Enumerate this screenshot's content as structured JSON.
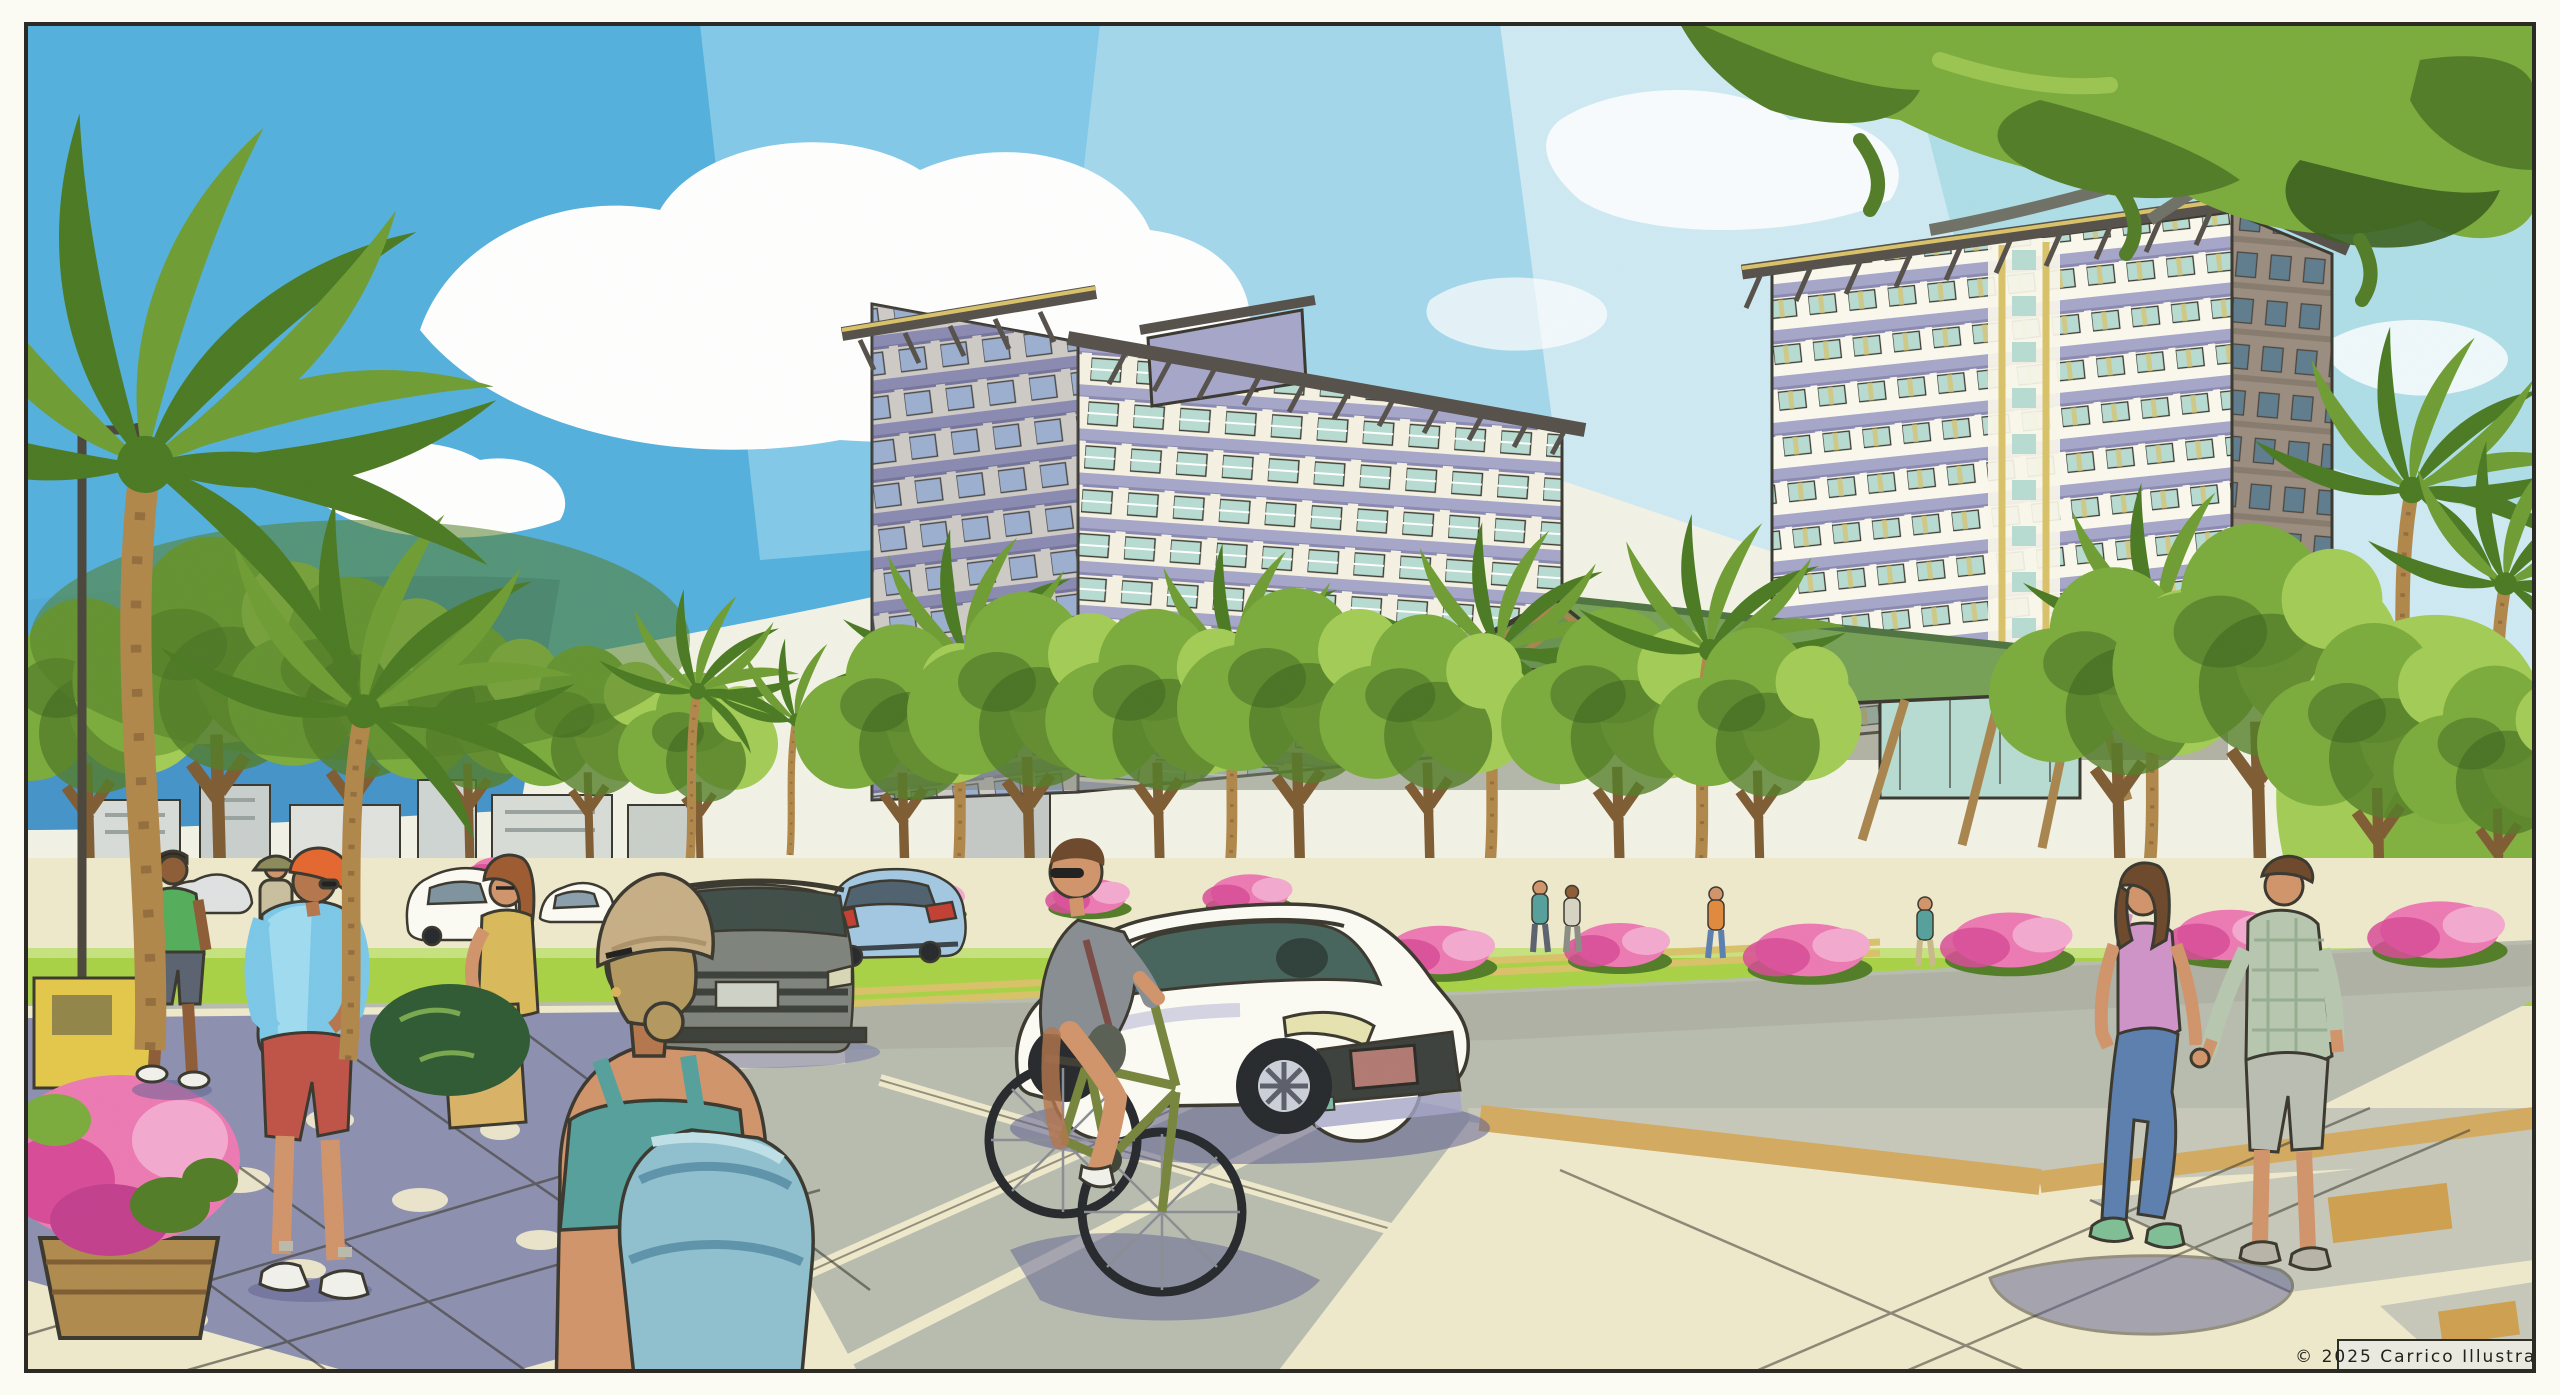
{
  "artwork": {
    "medium": "watercolor and ink architectural rendering",
    "caption": "© 2025  Carrico Illustration"
  },
  "scene": {
    "setting": "sunny tropical resort boulevard with landscaped medians, street trees and a foreground crosswalk",
    "sky": "blue watercolor sky with large white cumulus clouds, paler toward the right",
    "buildings": [
      {
        "name": "left-midrise",
        "floors_visible": 10,
        "features": "deep bracketed roof overhangs, lavender balcony bands, teal glazing, rooftop stair box, green entry canopy"
      },
      {
        "name": "right-tower",
        "floors_visible": 13,
        "features": "white frame facade with recessed lavender balconies, yellow core accents, bracketed eave, shaded taupe side wall"
      },
      {
        "name": "amenity-pavilion",
        "features": "low glass pavilion, green sloped metal roof, exposed timber trusses and angled struts"
      }
    ],
    "vehicles": [
      {
        "name": "white-sedan",
        "pose": "three-quarter front view driving toward viewer, dark grille, rose license plate"
      },
      {
        "name": "gray-suv",
        "pose": "front view in far lane"
      },
      {
        "name": "light-blue-sedan",
        "pose": "rear view driving away, red taillights"
      },
      {
        "name": "parked-white-cars",
        "pose": "along far left curb"
      }
    ],
    "people": [
      {
        "name": "cyclist",
        "desc": "man with sunglasses on olive-green bicycle, gray shirt, crossbody bag, white sneakers"
      },
      {
        "name": "man-orange-cap",
        "desc": "standing with hands on hips, light blue tee, red shorts, white sneakers"
      },
      {
        "name": "man-green-polo",
        "desc": "walking, green polo, gray shorts, white sneakers"
      },
      {
        "name": "woman-yellow-top",
        "desc": "auburn hair, glasses, mustard top, tan tote bag"
      },
      {
        "name": "woman-foreground",
        "desc": "back view, tan beanie over blonde bun, sunglasses, teal tank, large teal backpack"
      },
      {
        "name": "pedestrian-bucket-hat",
        "desc": "distant walker in olive bucket hat"
      },
      {
        "name": "couple-walking",
        "desc": "woman in pink cami, jeans and green sneakers holding hands with man in sage plaid shirt and gray shorts"
      },
      {
        "name": "distant-pedestrians",
        "desc": "small figures strolling the far promenade"
      }
    ],
    "vegetation": [
      "tall coconut palms on the left",
      "bright street-tree allee in front of the buildings",
      "pink azalea masses along the medians",
      "overhanging shade-tree canopy across the top right",
      "barrel planter of magenta petunias at lower left"
    ],
    "street": [
      "double yellow center line",
      "cream crosswalk and lane markings",
      "lime lawn median strips",
      "tan paver accent bands",
      "dappled leaf shadows on the sidewalk",
      "street light pole"
    ]
  },
  "palette": {
    "ink": "#3a382e",
    "frame": "#2b2a24",
    "paper": "#fbfaf3",
    "artBase": "#f2f3e6",
    "skyDeep": "#54b0dd",
    "skyMid": "#8fd0ec",
    "skyPale": "#cfeaf4",
    "skyAqua": "#9fd9e2",
    "horizon": "#4493c9",
    "cloud": "#ffffff",
    "cloudShade": "#dceef4",
    "leafLight": "#a3cc55",
    "leafMid": "#7bab3c",
    "leafDark": "#527d27",
    "leafDeep": "#3a5f1d",
    "lawn": "#a9d246",
    "lawnPale": "#c6e27e",
    "palmLight": "#6f9d33",
    "palmDark": "#4b7a22",
    "trunk": "#b1874a",
    "trunkDark": "#7e5c33",
    "branch": "#6f7166",
    "facade": "#f5f2e3",
    "facadeShade": "#ddd9cc",
    "lavender": "#a6a6c9",
    "lavenderDeep": "#8a8ab2",
    "glass": "#b7dcd2",
    "glassBlue": "#9fb7d6",
    "glassDark": "#5e7d8e",
    "taupe": "#9a8d7f",
    "accentYellow": "#d9c268",
    "roofDark": "#55504a",
    "roofGreen": "#76a156",
    "timber": "#a9854d",
    "road": "#b8bcae",
    "roadShade": "#a6aa9c",
    "cream": "#efe9cc",
    "tanBand": "#d3aa60",
    "ochre": "#cfa04f",
    "paverGray": "#c6c8ba",
    "shadow": "#7478a8",
    "shadowDeep": "#5c5f92",
    "skin": "#d1946a",
    "skinShade": "#b5764c",
    "skinDark": "#8d5c36",
    "hairBrown": "#6d482b",
    "hairAuburn": "#9d5a30",
    "hairBlonde": "#b3985f",
    "greenShirt": "#53ae5b",
    "blueShirt": "#7cc8e8",
    "blueShirtShade": "#4594c4",
    "redShorts": "#bf5247",
    "orangeCap": "#e4662f",
    "mustard": "#d9ba5b",
    "tote": "#d9b265",
    "beanie": "#c7ae85",
    "teal": "#55a09b",
    "backpack": "#8fc0cf",
    "backpackShade": "#5e93ab",
    "grayShirt": "#878d92",
    "slate": "#5a6270",
    "bikeOlive": "#76853c",
    "pinkTop": "#cf93c8",
    "jeans": "#5b7fae",
    "plaid": "#b7c7af",
    "shortsGray": "#b9bdb2",
    "shoeGreen": "#7fbf96",
    "suv": "#7e837b",
    "carBlue": "#a3c8e2",
    "carWhite": "#fcfbf4",
    "tire": "#26292c",
    "alloy": "#ccd0d8",
    "plate": "#b17a72",
    "glassCar": "#46645c",
    "tail": "#c23f32",
    "azalea": "#ec7ab2",
    "azaleaDeep": "#d84b98",
    "azaleaLight": "#f4a9cf",
    "white": "#ffffff"
  }
}
